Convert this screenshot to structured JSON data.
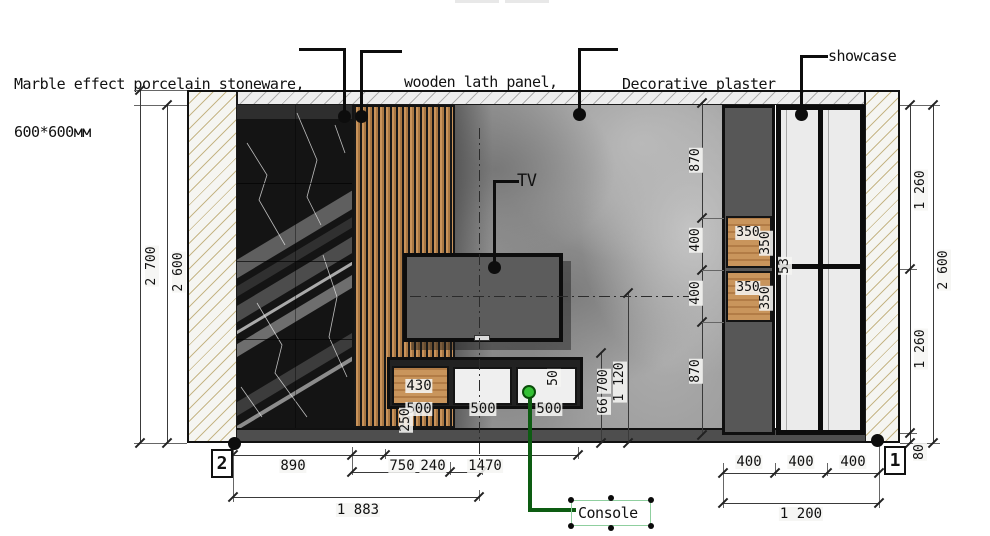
{
  "annotations": {
    "marble": {
      "line1": "Marble effect porcelain stoneware,",
      "line2": "600*600мм"
    },
    "wood": {
      "line1": "wooden lath panel,",
      "line2": "oak tree,30*15мм"
    },
    "plaster": {
      "line1": "Decorative plaster",
      "line2": "gray color"
    },
    "showcase": {
      "label": "showcase"
    },
    "tv": {
      "label": "TV"
    },
    "console": {
      "label": "Console"
    }
  },
  "dimensions": {
    "left": {
      "overall": "2 700",
      "interior": "2 600"
    },
    "right": {
      "upper": "1 260",
      "lower": "1 260",
      "interior": "2 600",
      "plinth": "80"
    },
    "middle_chain": [
      "870",
      "400",
      "400",
      "870"
    ],
    "cabinet_box": {
      "width": "350",
      "height": "350"
    },
    "showcase_frame": "53",
    "console": {
      "height": "250",
      "cabinet_width": "430",
      "drawer_widths": [
        "500",
        "500",
        "500"
      ],
      "top_gap": "50",
      "console_height": "700",
      "gap": "66",
      "tv_axis_height": "1 120"
    },
    "bottom_left": {
      "segments": [
        "890",
        "750",
        "240",
        "1470"
      ],
      "total": "1 883"
    },
    "bottom_right": {
      "segments": [
        "400",
        "400",
        "400"
      ],
      "total": "1 200"
    }
  },
  "markers": {
    "left": "2",
    "right": "1"
  },
  "colors": {
    "marble_bg": "#141414",
    "wood": "#c4905a",
    "plaster_base": "#989898",
    "cabinet_gray": "#575757",
    "showcase_panel": "#ebebeb",
    "console_green": "#1b7a1f",
    "floor": "#4e4e4e"
  }
}
